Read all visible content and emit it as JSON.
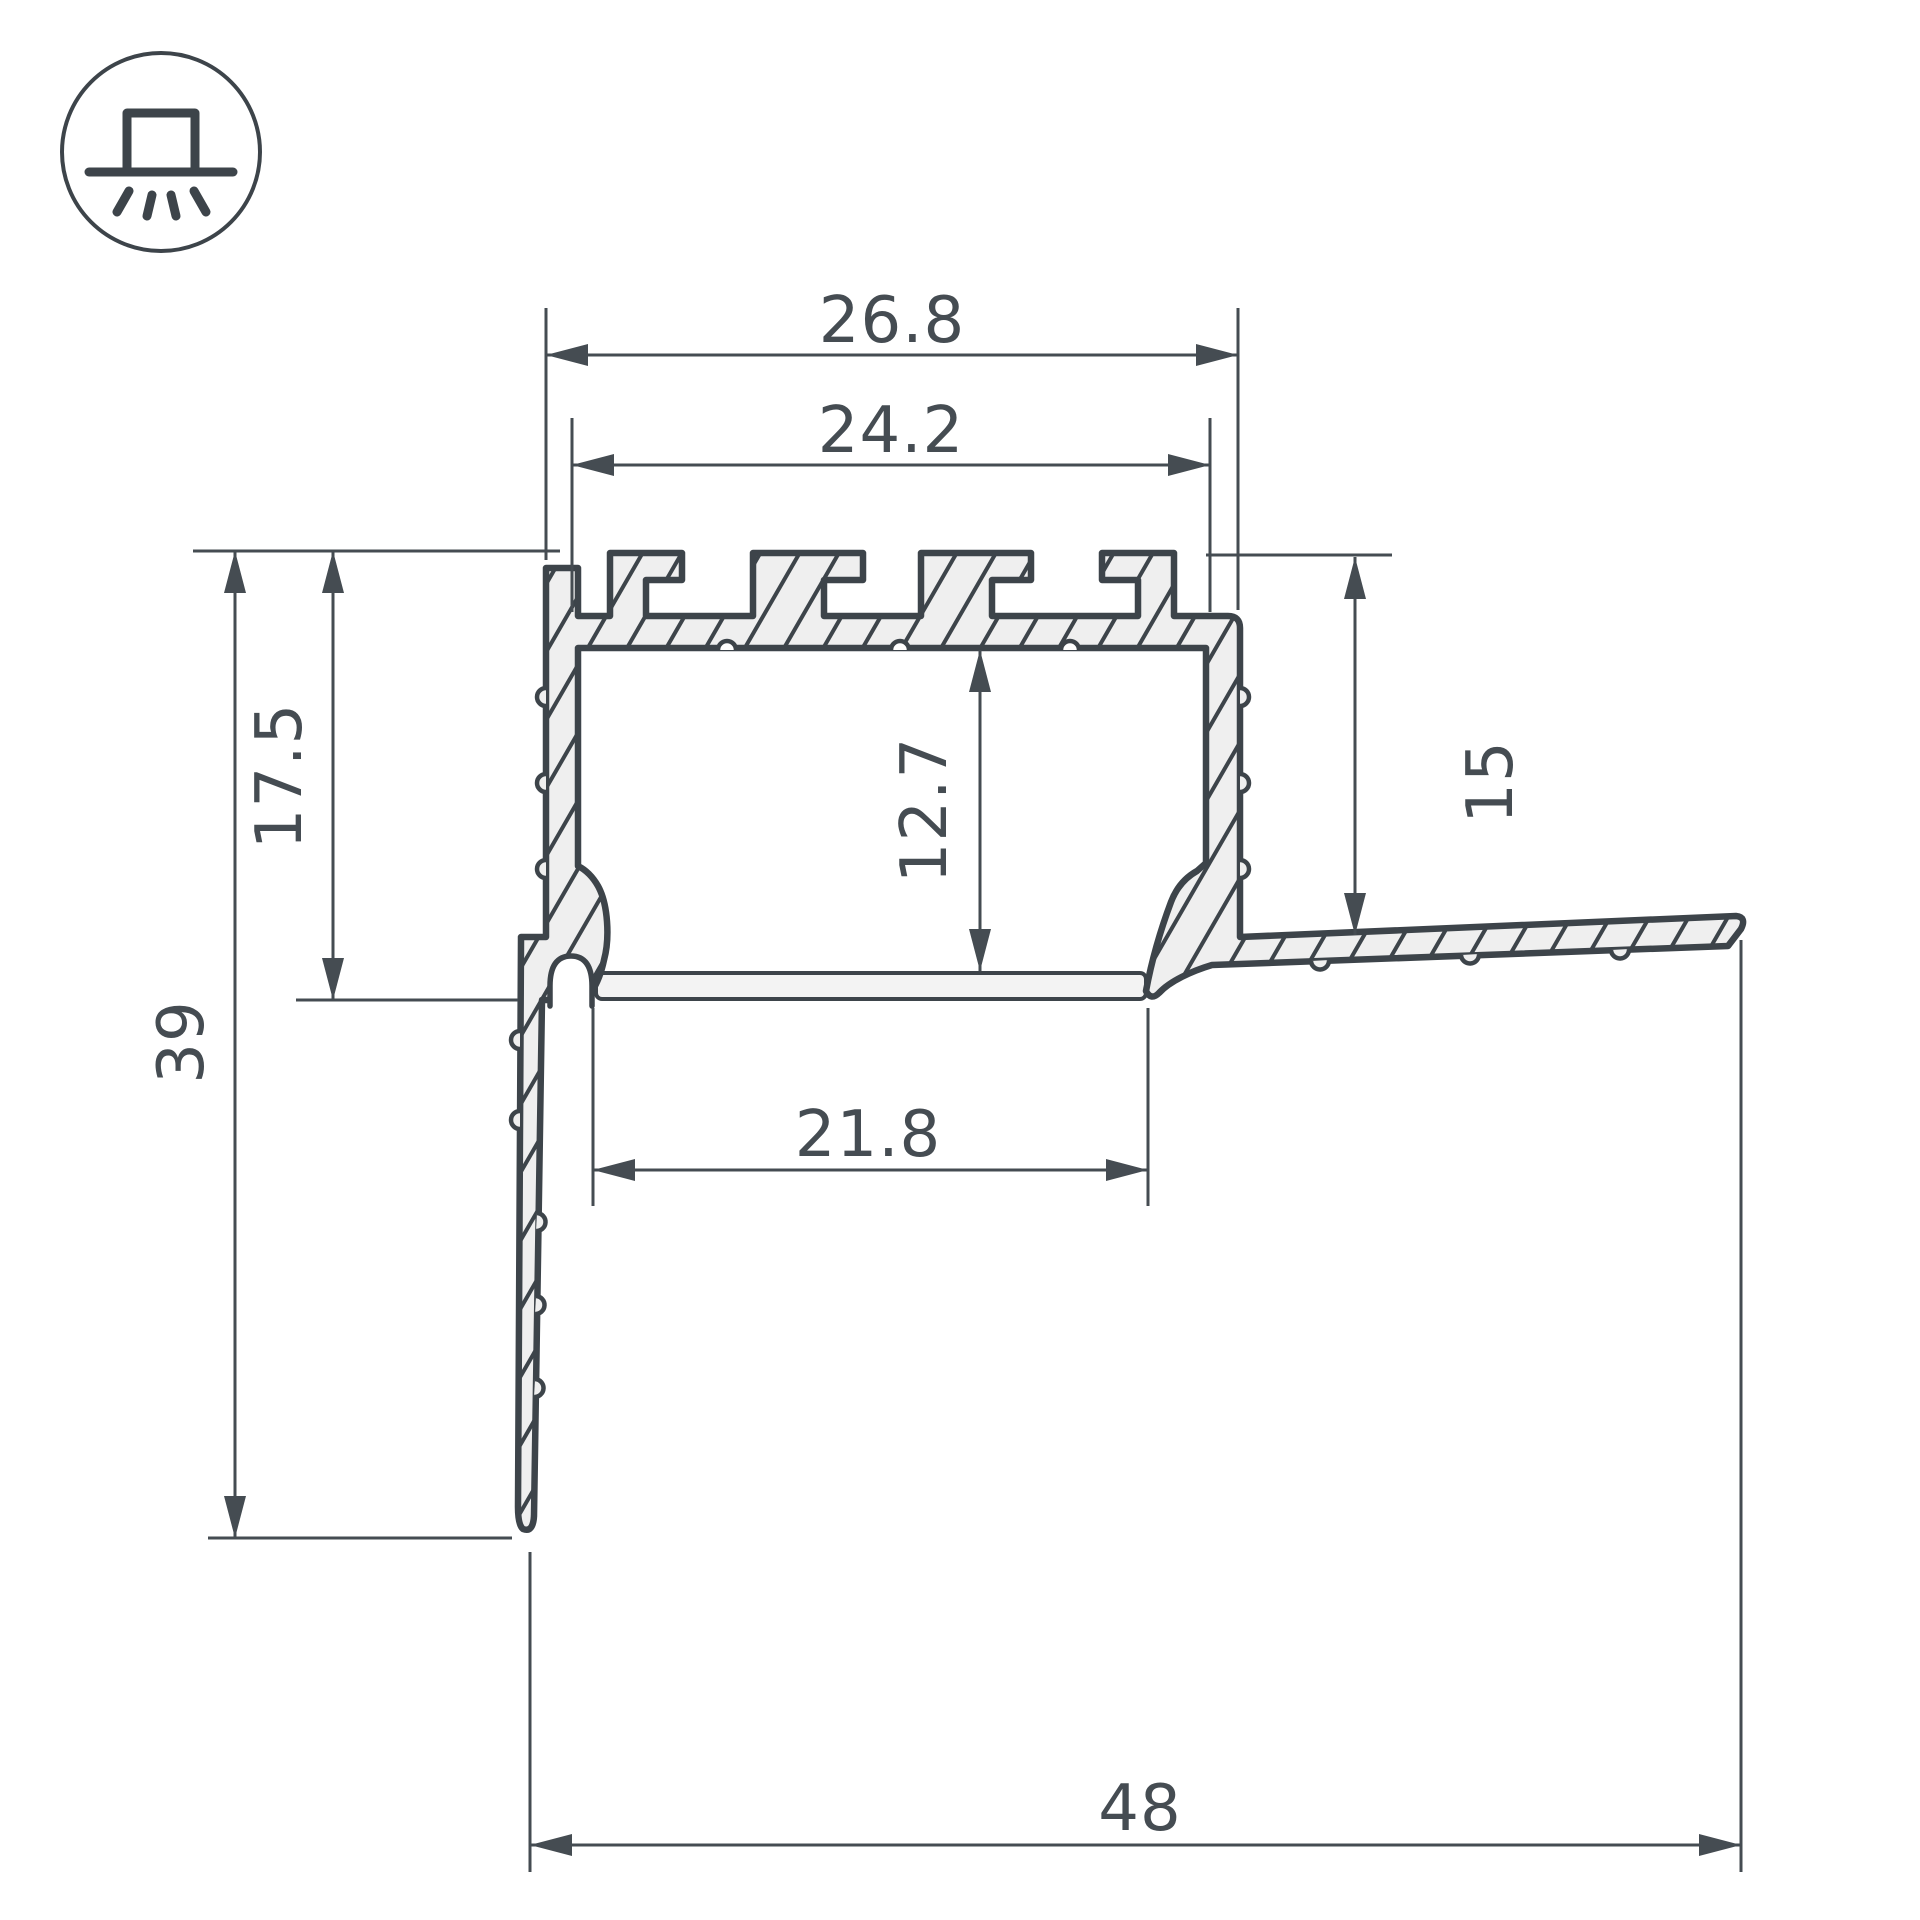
{
  "drawing": {
    "kind": "led-profile-cross-section",
    "dimensions": {
      "top_outer_width": "26.8",
      "top_inner_width": "24.2",
      "left_recess_depth": "17.5",
      "left_total_height": "39",
      "right_flange_drop": "15",
      "inner_cavity_height": "12.7",
      "bottom_opening_width": "21.8",
      "total_width": "48"
    }
  },
  "icon": {
    "name": "recessed-light-icon"
  },
  "colors": {
    "line": "#3d444a",
    "dimension": "#454c52",
    "material_fill": "#efefef",
    "cover_fill": "#f3f3f3",
    "background": "#ffffff"
  }
}
